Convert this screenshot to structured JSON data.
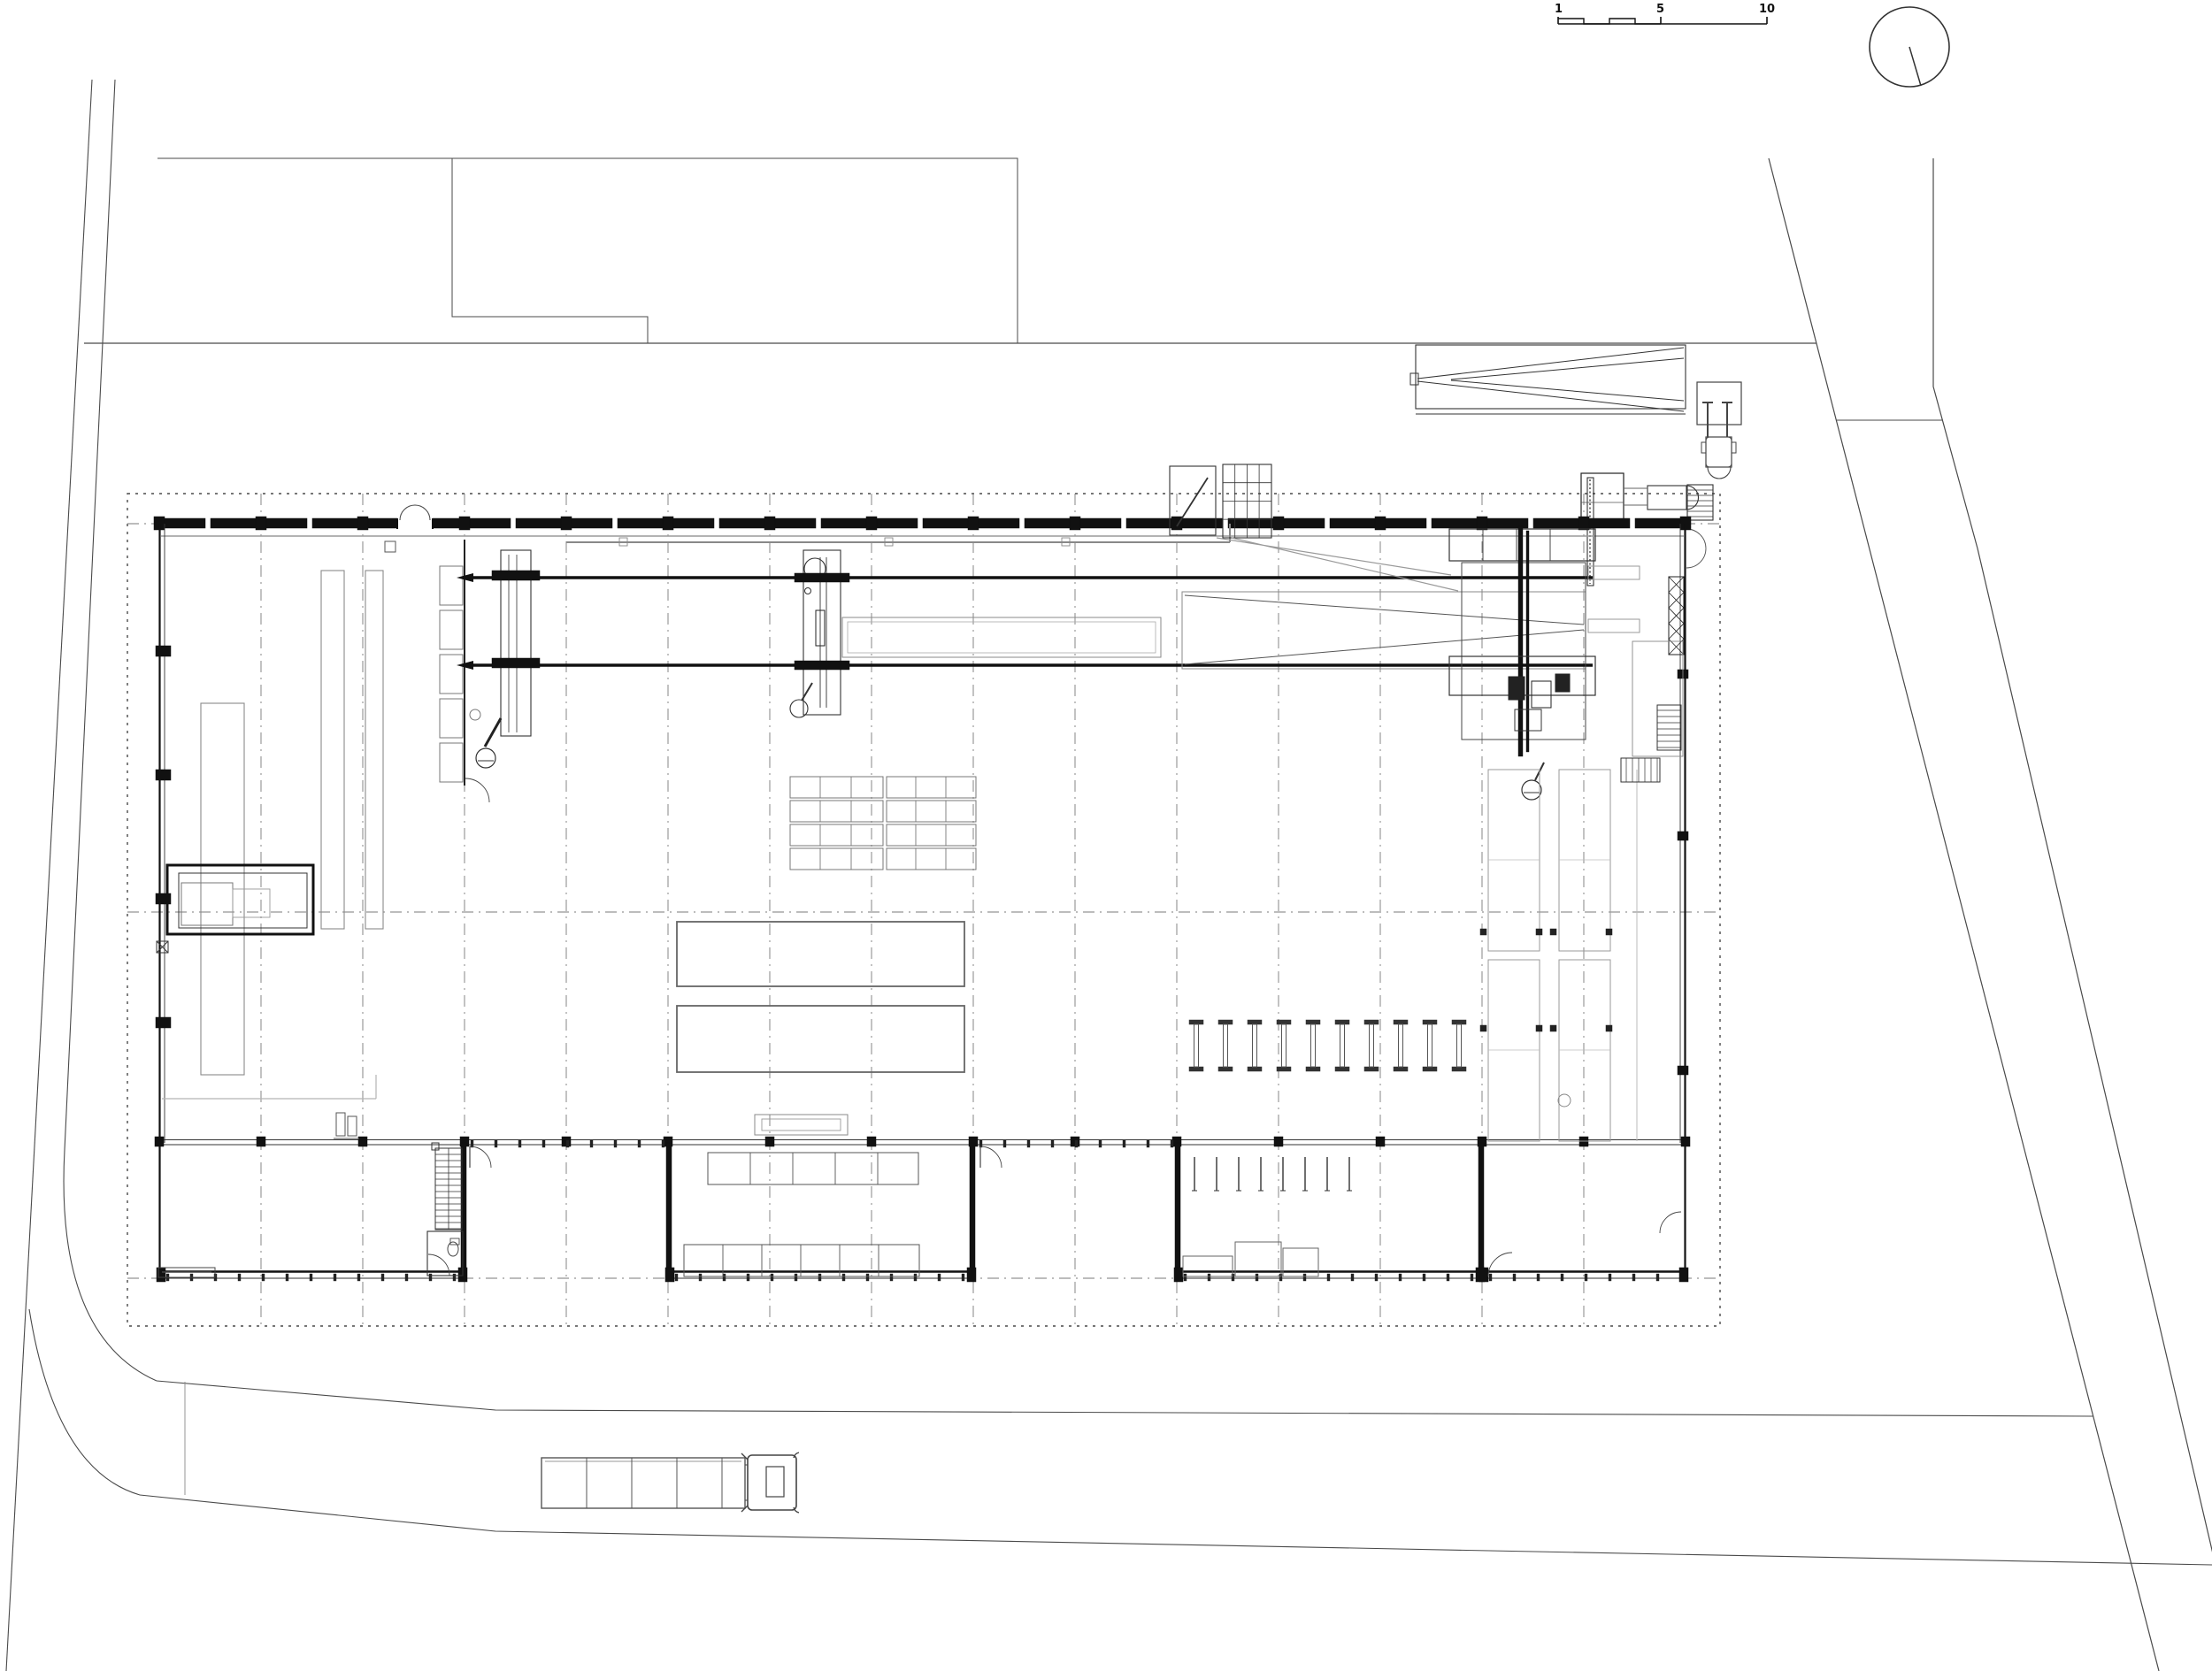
{
  "drawing": {
    "kind": "architectural-site-plan",
    "scale_bar": {
      "labels": [
        "1",
        "5",
        "10"
      ]
    },
    "north_indicator": "circle-with-needle",
    "palette": {
      "ink": "#1c1c1c",
      "wall": "#111111",
      "medium": "#555555",
      "light": "#8a8a8a",
      "faint": "#aaaaaa",
      "grid": "#7a7a7a",
      "site": "#4a4a4a",
      "paper": "#ffffff"
    },
    "elements": {
      "building": "factory-hall",
      "north_zone": "crane-rails-and-saw-line",
      "west_zone": "racking-and-partition-bay",
      "east_zone": "storage-racks",
      "south_zone": "three-wings-with-courtyards",
      "site": "roads-plot-boundaries-truck-forklift"
    }
  }
}
